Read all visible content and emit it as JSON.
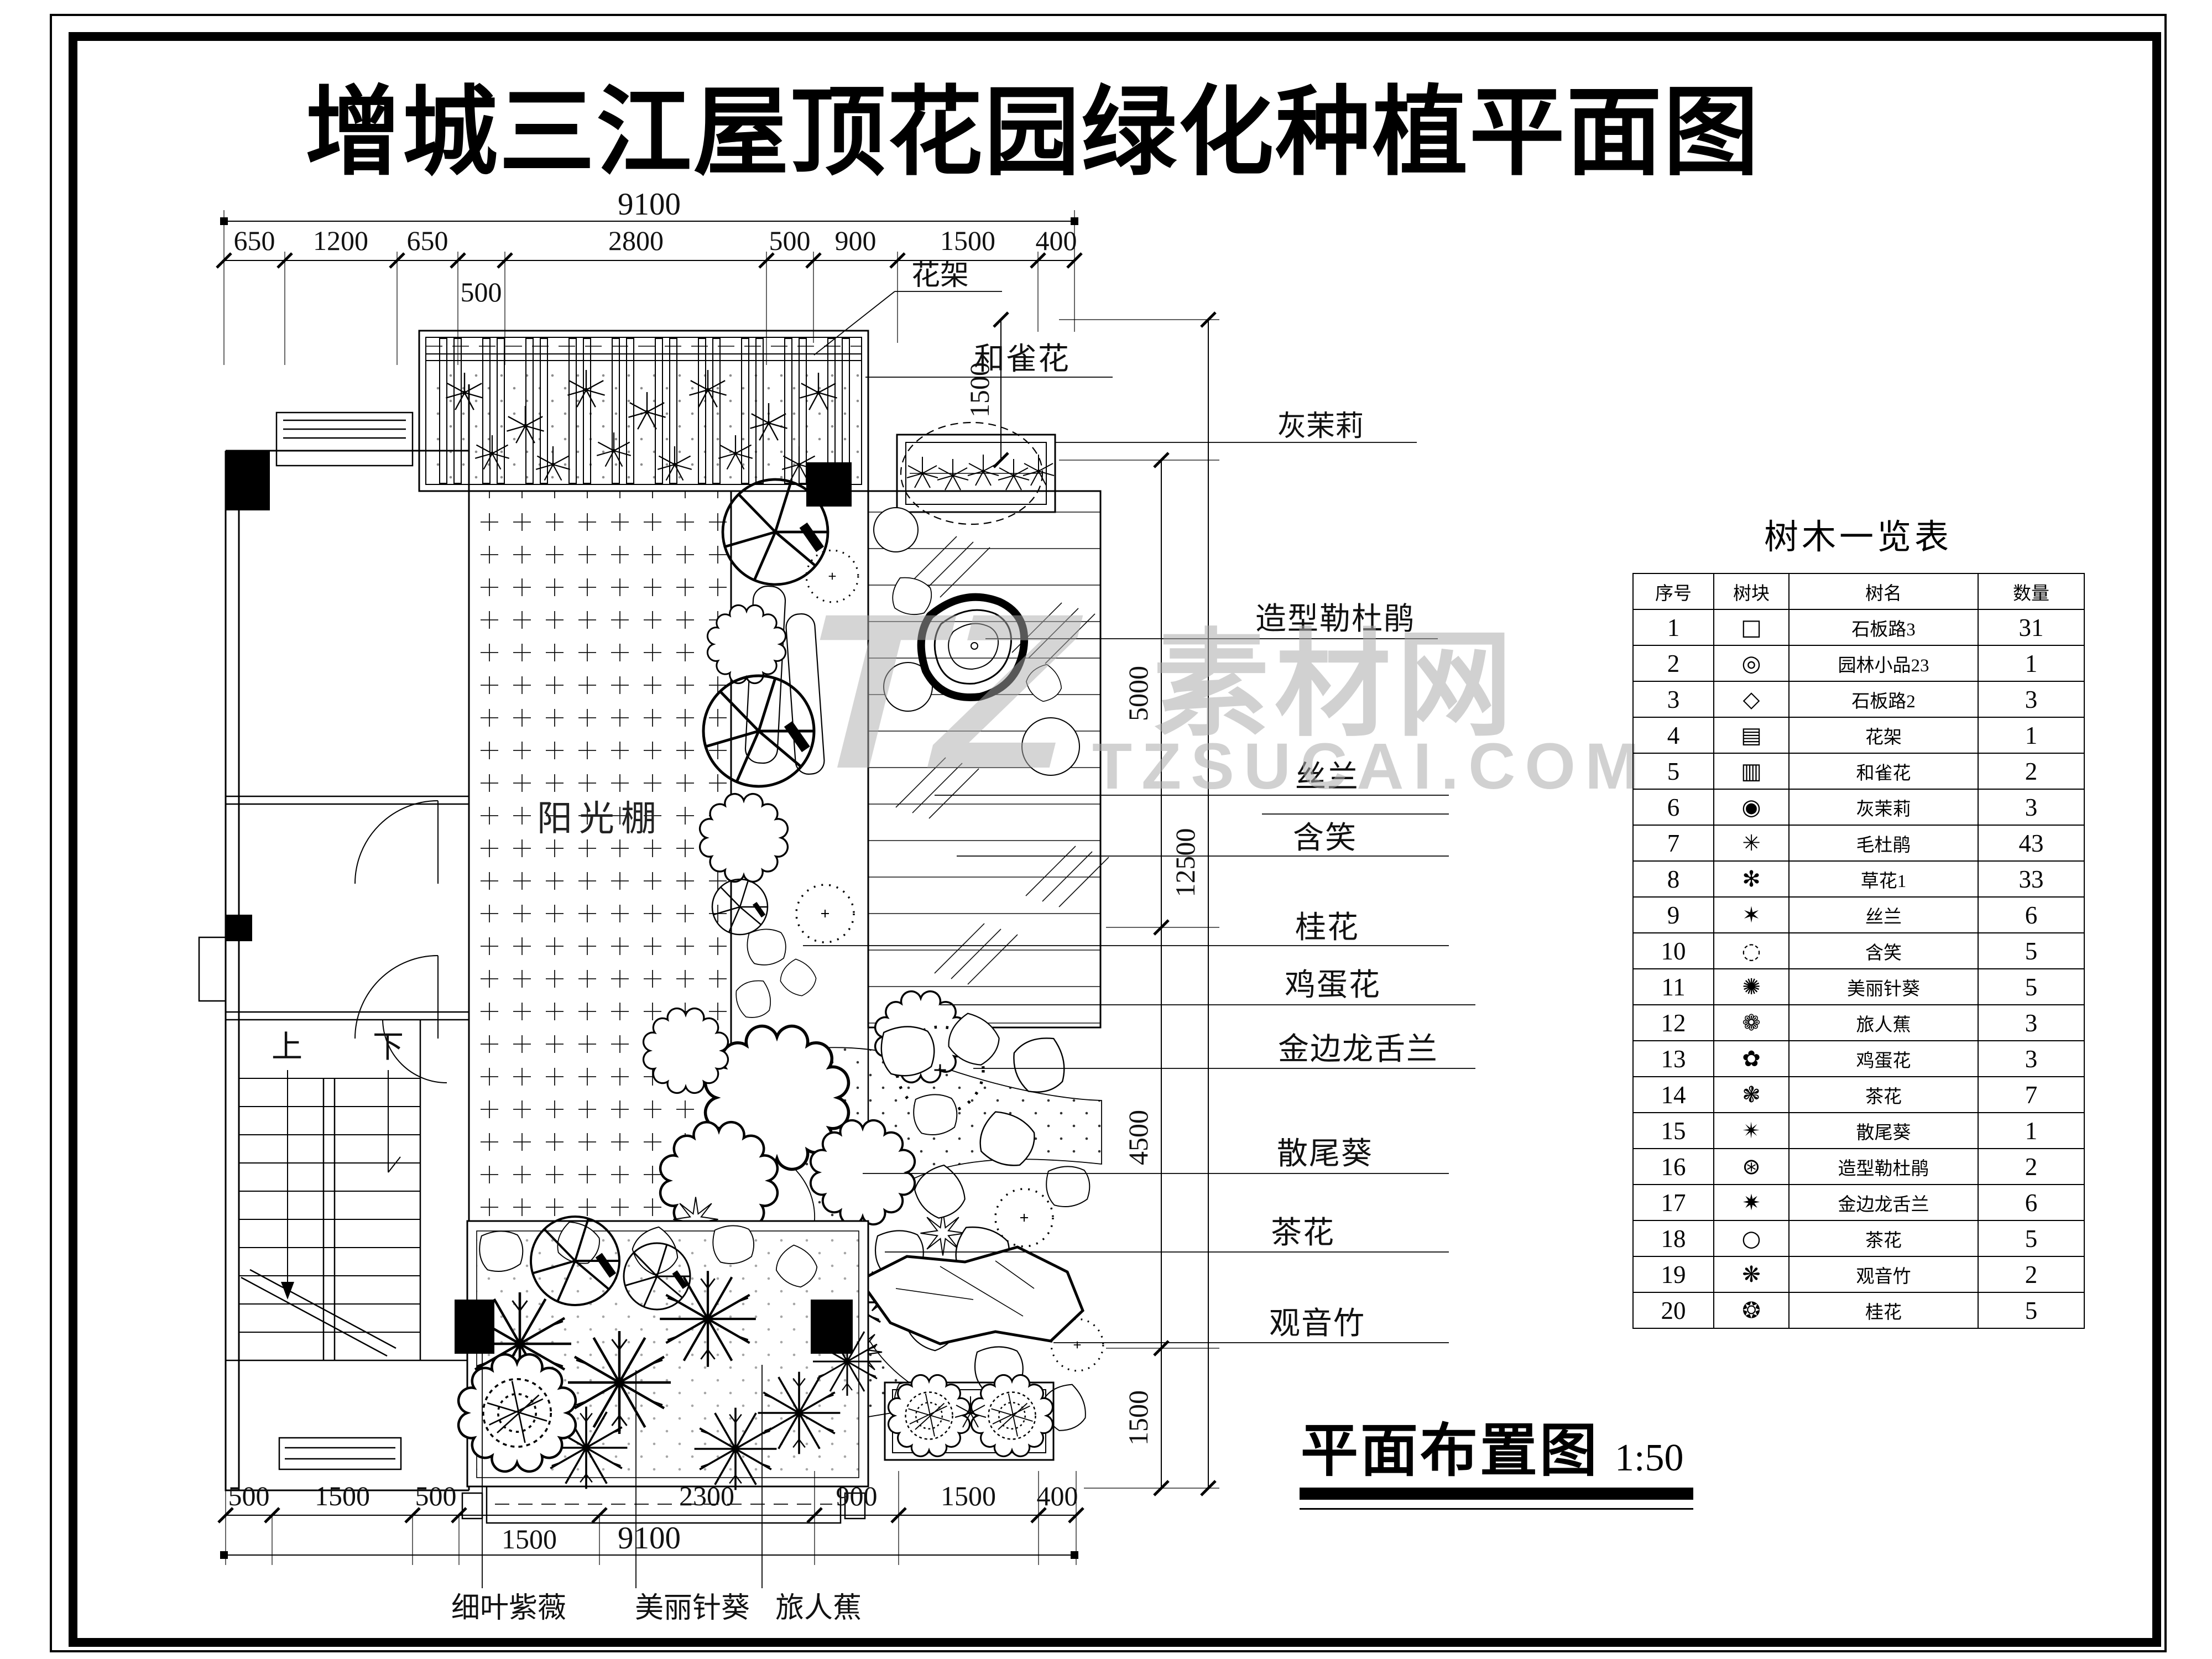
{
  "title": "增城三江屋顶花园绿化种植平面图",
  "watermark": {
    "tz": "TZ",
    "name": "素材网",
    "url": "TZSUCAI.COM"
  },
  "caption": {
    "text": "平面布置图",
    "scale": "1:50"
  },
  "plan": {
    "labels": {
      "pergola": "花架",
      "hequehua": "和雀花",
      "huimoli": "灰茉莉",
      "sunroom": "阳光棚",
      "stair_up": "上",
      "stair_down": "下"
    },
    "callouts_right": [
      "造型勒杜鹃",
      "丝兰",
      "含笑",
      "桂花",
      "鸡蛋花",
      "金边龙舌兰",
      "散尾葵",
      "茶花",
      "观音竹"
    ],
    "callouts_bottom": [
      "细叶紫薇",
      "美丽针葵",
      "旅人蕉"
    ]
  },
  "dimensions": {
    "top": {
      "overall": "9100",
      "segments": [
        "650",
        "1200",
        "650",
        "2800",
        "500",
        "900",
        "1500",
        "400"
      ],
      "below": "500"
    },
    "bottom": {
      "overall": "9100",
      "segments": [
        "500",
        "1500",
        "500",
        "2300",
        "900",
        "1500",
        "400"
      ],
      "below": "1500"
    },
    "right": [
      "1500",
      "5000",
      "12500",
      "4500",
      "1500"
    ]
  },
  "table": {
    "title": "树木一览表",
    "headers": [
      "序号",
      "树块",
      "树名",
      "数量"
    ],
    "rows": [
      {
        "no": "1",
        "symbol": "□",
        "name": "石板路3",
        "qty": "31"
      },
      {
        "no": "2",
        "symbol": "◎",
        "name": "园林小品23",
        "qty": "1"
      },
      {
        "no": "3",
        "symbol": "◇",
        "name": "石板路2",
        "qty": "3"
      },
      {
        "no": "4",
        "symbol": "▤",
        "name": "花架",
        "qty": "1"
      },
      {
        "no": "5",
        "symbol": "▥",
        "name": "和雀花",
        "qty": "2"
      },
      {
        "no": "6",
        "symbol": "◉",
        "name": "灰茉莉",
        "qty": "3"
      },
      {
        "no": "7",
        "symbol": "✳",
        "name": "毛杜鹃",
        "qty": "43"
      },
      {
        "no": "8",
        "symbol": "✻",
        "name": "草花1",
        "qty": "33"
      },
      {
        "no": "9",
        "symbol": "✶",
        "name": "丝兰",
        "qty": "6"
      },
      {
        "no": "10",
        "symbol": "◌",
        "name": "含笑",
        "qty": "5"
      },
      {
        "no": "11",
        "symbol": "✺",
        "name": "美丽针葵",
        "qty": "5"
      },
      {
        "no": "12",
        "symbol": "❁",
        "name": "旅人蕉",
        "qty": "3"
      },
      {
        "no": "13",
        "symbol": "✿",
        "name": "鸡蛋花",
        "qty": "3"
      },
      {
        "no": "14",
        "symbol": "❃",
        "name": "茶花",
        "qty": "7"
      },
      {
        "no": "15",
        "symbol": "✴",
        "name": "散尾葵",
        "qty": "1"
      },
      {
        "no": "16",
        "symbol": "⊛",
        "name": "造型勒杜鹃",
        "qty": "2"
      },
      {
        "no": "17",
        "symbol": "✷",
        "name": "金边龙舌兰",
        "qty": "6"
      },
      {
        "no": "18",
        "symbol": "○",
        "name": "茶花",
        "qty": "5"
      },
      {
        "no": "19",
        "symbol": "❋",
        "name": "观音竹",
        "qty": "2"
      },
      {
        "no": "20",
        "symbol": "❂",
        "name": "桂花",
        "qty": "5"
      }
    ]
  },
  "colors": {
    "line": "#000000",
    "watermark": "#adadad",
    "paper": "#ffffff"
  }
}
